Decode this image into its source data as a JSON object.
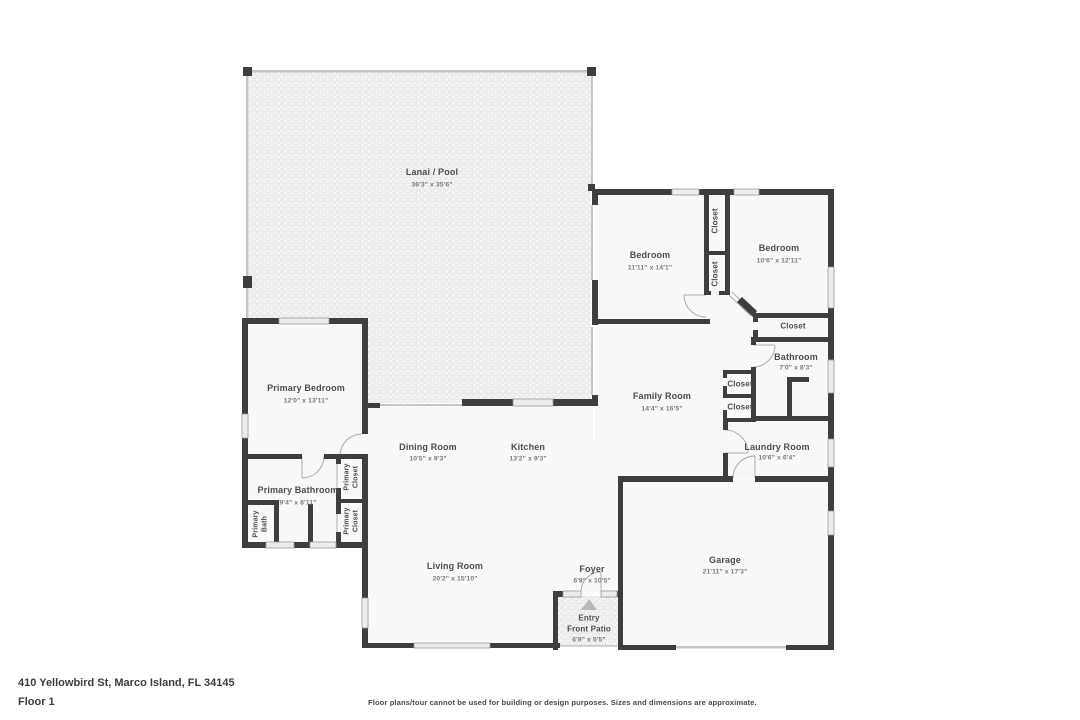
{
  "floorplan": {
    "address": "410 Yellowbird St, Marco Island, FL 34145",
    "floor_label": "Floor 1",
    "disclaimer": "Floor plans/tour cannot be used for building or design purposes. Sizes and dimensions are approximate.",
    "colors": {
      "wall": "#3e3e3e",
      "room_fill": "#f8f8f8",
      "hatch_dot": "#e0e0e0",
      "window": "#ececec",
      "screen_wall": "#c6c6c6",
      "door_arc": "#aeaeae",
      "north_arrow": "#b9b9b9"
    },
    "rooms": {
      "lanai": {
        "name": "Lanai / Pool",
        "dims": "36'3\" x 35'6\""
      },
      "bedroom1": {
        "name": "Bedroom",
        "dims": "11'11\" x 14'1\""
      },
      "bedroom2": {
        "name": "Bedroom",
        "dims": "10'6\" x 12'11\""
      },
      "closet_hall_top": {
        "name": "Closet"
      },
      "closet_hall_bot": {
        "name": "Closet"
      },
      "closet_bedroom2": {
        "name": "Closet"
      },
      "bathroom": {
        "name": "Bathroom",
        "dims": "7'0\" x 8'3\""
      },
      "closet_family_1": {
        "name": "Closet"
      },
      "closet_family_2": {
        "name": "Closet"
      },
      "family_room": {
        "name": "Family Room",
        "dims": "14'4\" x 16'5\""
      },
      "laundry": {
        "name": "Laundry Room",
        "dims": "10'6\" x 6'4\""
      },
      "primary_bedroom": {
        "name": "Primary Bedroom",
        "dims": "12'0\" x 13'11\""
      },
      "dining": {
        "name": "Dining Room",
        "dims": "10'5\" x 9'3\""
      },
      "kitchen": {
        "name": "Kitchen",
        "dims": "13'2\" x 9'3\""
      },
      "primary_bathroom": {
        "name": "Primary Bathroom",
        "dims": "9'4\" x 8'11\""
      },
      "primary_closet_1": {
        "name": "Primary Closet"
      },
      "primary_closet_2": {
        "name": "Primary Closet"
      },
      "primary_bath": {
        "name": "Primary Bath"
      },
      "living": {
        "name": "Living Room",
        "dims": "20'2\" x 15'10\""
      },
      "foyer": {
        "name": "Foyer",
        "dims": "6'8\" x 10'5\""
      },
      "entry": {
        "name": "Entry",
        "name2": "Front Patio",
        "dims": "6'8\" x 5'5\""
      },
      "garage": {
        "name": "Garage",
        "dims": "21'11\" x 17'3\""
      }
    }
  }
}
